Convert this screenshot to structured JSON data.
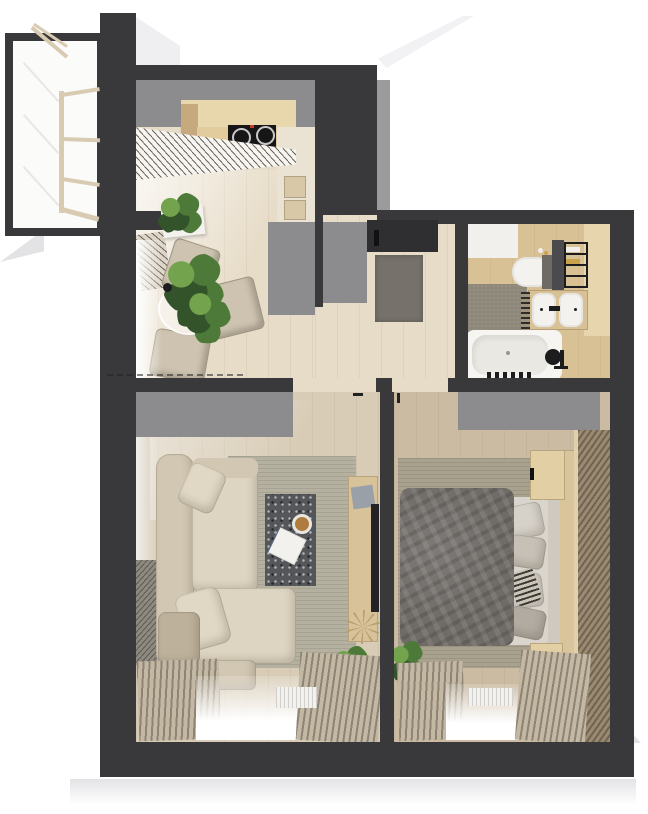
{
  "scene": {
    "title": "apartment-floor-plan-top-view",
    "type": "photorealistic 3d floor plan render, no visible text"
  },
  "rooms": [
    {
      "id": "balcony",
      "label": "glazed balcony"
    },
    {
      "id": "kitchen",
      "label": "kitchen"
    },
    {
      "id": "dining-area",
      "label": "dining area"
    },
    {
      "id": "entry-hall",
      "label": "entry hall"
    },
    {
      "id": "bathroom",
      "label": "bathroom"
    },
    {
      "id": "living-room",
      "label": "living room"
    },
    {
      "id": "bedroom",
      "label": "bedroom"
    }
  ],
  "furniture": {
    "kitchen": [
      "counter-with-cooktop",
      "induction-hob-4-burners",
      "tall-cabinet",
      "slatted-bench",
      "potted-plant"
    ],
    "dining-area": [
      "round-glass-table",
      "three-upholstered-chairs",
      "table-plants",
      "black-vase",
      "radiator"
    ],
    "entry-hall": [
      "open-entry-door",
      "doormat",
      "two-wardrobe-blocks"
    ],
    "bathroom": [
      "toilet",
      "double-sink-counter",
      "dark-vanity",
      "towel-ladder",
      "bathtub",
      "black-shower-fixture",
      "bottles"
    ],
    "living-room": [
      "corner-sofa",
      "throw-pillows",
      "terrazzo-coffee-table",
      "coffee-cup",
      "open-book",
      "area-rug",
      "tv-on-partition",
      "wood-console",
      "wardrobe-block",
      "curtains-with-sheer-window",
      "radiator",
      "potted-plant",
      "starburst-decor",
      "wall-vent-grille"
    ],
    "bedroom": [
      "double-bed",
      "gray-duvet",
      "pillows",
      "striped-pillow",
      "headboard",
      "wood-bed-panel",
      "two-nightstands",
      "area-rug",
      "wardrobe-block",
      "slatted-wall-panel",
      "curtains-with-sheer-window",
      "radiator",
      "potted-plant"
    ]
  },
  "colors": {
    "wall": "#39383b",
    "wallFace": "#9b9b9e",
    "grayBlock": "#8c8c8e",
    "shadow": "#e3e3e6",
    "shadowSoft": "#efeff1",
    "floor": "#e7dcc8",
    "floorLiving": "#d8ccb6",
    "floorBedroom": "#cbbba2",
    "bathWood": "#d9c196",
    "bathWoodLight": "#e7d5ae",
    "counterPanel": "#e8d6ac",
    "counter": "#e2cc9e",
    "counterSide": "#c6a97c",
    "cooktop": "#161616",
    "burner": "#c8c8c8",
    "hobRed": "#c03a2e",
    "cabinet": "#eae3d4",
    "appliance": "#d8c8a8",
    "slatStripe": "#6b6458",
    "plantDark": "#33532a",
    "plantMid": "#4d7a38",
    "plantLight": "#74a34e",
    "planter": "#f4f2ee",
    "chair": "#cdc3b0",
    "chairShade": "#b3a790",
    "vase": "#1d1d1f",
    "doormat": "#76726b",
    "door": "#2f2e31",
    "black": "#111111",
    "tile": "#8e887a",
    "tub": "#f6f5f2",
    "tubInner": "#eae8e3",
    "vanity": "#4b4a4c",
    "tankGray": "#6e6b66",
    "sink": "#f3f2ef",
    "fixture": "#1c1c1e",
    "towel": "#c9a24b",
    "sofa": "#d2c7b2",
    "sofaLight": "#ddd4c2",
    "sofaShade": "#bdb19b",
    "rugLiving": "#b5b1a0",
    "rugBedroom": "#a8a18d",
    "coffeeTable": "#54565a",
    "cup": "#b07b3e",
    "bookWhite": "#f2f1ee",
    "bookStrap": "#5b6b8c",
    "console": "#d7c299",
    "bookGray": "#9aa0a8",
    "tv": "#232325",
    "starburst": "#bb9e6d",
    "duvet": "#6f6b67",
    "mattress": "#d9d4cc",
    "pillowLight": "#d6d1c9",
    "pillowMid": "#b1aba1",
    "pillowStripe": "#3e3a35",
    "headboard": "#cfc9bf",
    "bedPanel": "#d9c49c",
    "nightstand": "#e3cfa4",
    "slatWood": "#9b8a6f",
    "slatWoodDark": "#6f6353",
    "curtain": "#c3b8a4",
    "curtainDark": "#8f8474",
    "radiator": "#f2f1ee",
    "mullion": "#d8cbb2",
    "glassLine": "#e9e7e3",
    "white": "#fbfbfa"
  }
}
